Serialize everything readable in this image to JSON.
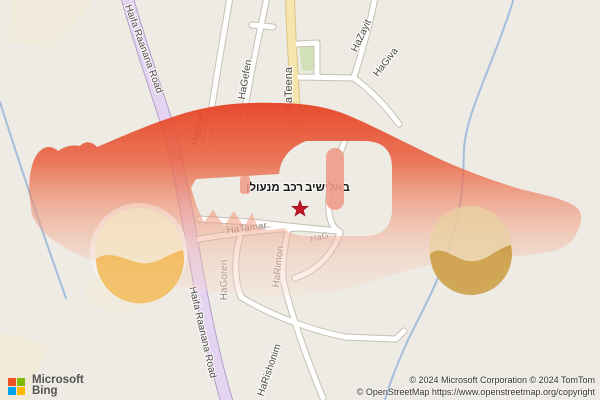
{
  "map": {
    "road_labels": {
      "haifa_top": "Haifa Raanana Road",
      "haifa_bottom": "Haifa Raanana Road",
      "hateena": "HaTeena",
      "hagefen": "HaGefen",
      "habeer": "HaBeer",
      "hazayit": "HaZayit",
      "hagiva": "HaGiva",
      "hatamar": "HaTamar",
      "hag": "HaG",
      "hagoren": "HaGoren",
      "harimon": "HaRimon",
      "harishonim": "HaRishonim"
    },
    "poi": {
      "name_words": [
        "מנעולן",
        "רכב",
        "באלישיב"
      ],
      "marker": "star",
      "marker_color": "#c41528"
    },
    "colors": {
      "background": "#edebe3",
      "primary_road": "#e4d4f1",
      "secondary_road": "#f6e6ad",
      "minor_road": "#ffffff",
      "water": "#9db8da",
      "park": "#cfe0b4",
      "car_overlay_top": "#e64527",
      "wheel_left": "#eca033",
      "wheel_right": "#b8872e",
      "key_slot": "#ef9c8a"
    }
  },
  "branding": {
    "line1": "Microsoft",
    "line2": "Bing",
    "square_colors": [
      "#f25022",
      "#7fba00",
      "#00a4ef",
      "#ffb900"
    ]
  },
  "attribution": {
    "line1": "© 2024 Microsoft Corporation © 2024 TomTom",
    "line2": "© OpenStreetMap https://www.openstreetmap.org/copyright"
  }
}
